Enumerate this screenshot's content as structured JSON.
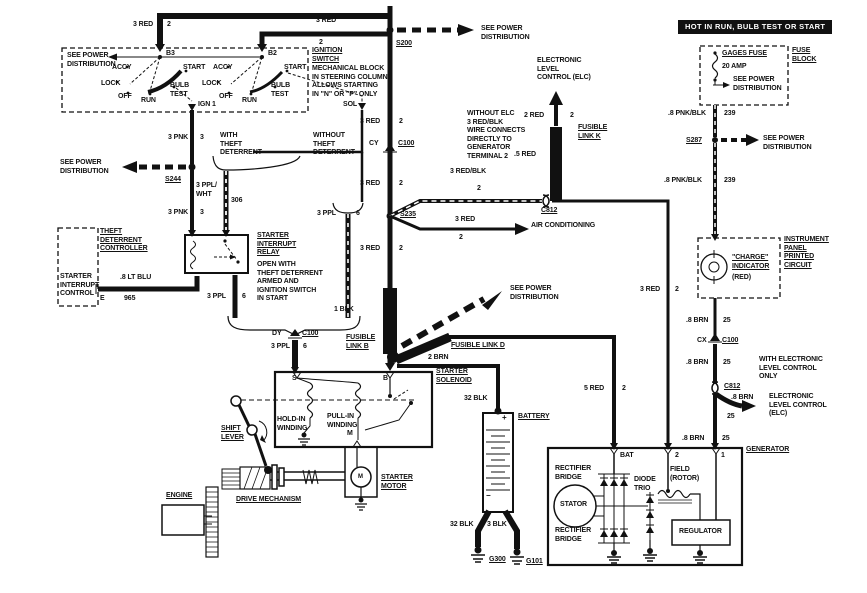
{
  "diagram": {
    "ink_color": "#111111",
    "paper_color": "#ffffff"
  },
  "labels": [
    {
      "n": "wire-3red-top-left",
      "t": "3 RED",
      "x": 133,
      "y": 21
    },
    {
      "n": "wire-ckt2-top-left",
      "t": "2",
      "x": 167,
      "y": 21
    },
    {
      "n": "wire-3red-top-mid",
      "t": "3 RED",
      "x": 316,
      "y": 17
    },
    {
      "n": "wire-ckt2-top-mid",
      "t": "2",
      "x": 319,
      "y": 39
    },
    {
      "n": "splice-s200",
      "t": "S200",
      "x": 396,
      "y": 40,
      "u": 1
    },
    {
      "n": "see-power-dist-top",
      "t": "SEE POWER\nDISTRIBUTION",
      "x": 481,
      "y": 25
    },
    {
      "n": "terminal-b3",
      "t": "B3",
      "x": 166,
      "y": 50
    },
    {
      "n": "terminal-b2",
      "t": "B2",
      "x": 268,
      "y": 50
    },
    {
      "n": "see-power-dist-ign",
      "t": "SEE POWER\nDISTRIBUTION",
      "x": 67,
      "y": 52
    },
    {
      "n": "sw1-accy",
      "t": "ACCY",
      "x": 112,
      "y": 64
    },
    {
      "n": "sw1-lock",
      "t": "LOCK",
      "x": 101,
      "y": 80
    },
    {
      "n": "sw1-off",
      "t": "OFF",
      "x": 118,
      "y": 93
    },
    {
      "n": "sw1-run",
      "t": "RUN",
      "x": 141,
      "y": 97
    },
    {
      "n": "sw1-bulb-test",
      "t": "BULB\nTEST",
      "x": 170,
      "y": 82
    },
    {
      "n": "sw1-start",
      "t": "START",
      "x": 183,
      "y": 64
    },
    {
      "n": "sw2-accy",
      "t": "ACCY",
      "x": 213,
      "y": 64
    },
    {
      "n": "sw2-lock",
      "t": "LOCK",
      "x": 202,
      "y": 80
    },
    {
      "n": "sw2-off",
      "t": "OFF",
      "x": 219,
      "y": 93
    },
    {
      "n": "sw2-run",
      "t": "RUN",
      "x": 242,
      "y": 97
    },
    {
      "n": "sw2-bulb-test",
      "t": "BULB\nTEST",
      "x": 271,
      "y": 82
    },
    {
      "n": "sw2-start",
      "t": "START",
      "x": 284,
      "y": 64
    },
    {
      "n": "terminal-ign1",
      "t": "IGN 1",
      "x": 198,
      "y": 101
    },
    {
      "n": "terminal-sol",
      "t": "SOL",
      "x": 343,
      "y": 101
    },
    {
      "n": "ignition-switch-title",
      "t": "IGNITION\nSWITCH",
      "x": 312,
      "y": 47,
      "u": 1
    },
    {
      "n": "ignition-switch-desc",
      "t": "MECHANICAL BLOCK\nIN STEERING COLUMN\nALLOWS STARTING\nIN \"N\" OR \"P\" ONLY",
      "x": 312,
      "y": 65
    },
    {
      "n": "wire-3pnk-upper",
      "t": "3 PNK",
      "x": 168,
      "y": 134
    },
    {
      "n": "wire-ckt3-upper",
      "t": "3",
      "x": 200,
      "y": 134
    },
    {
      "n": "with-theft-deterrent",
      "t": "WITH\nTHEFT\nDETERRENT",
      "x": 220,
      "y": 132
    },
    {
      "n": "without-theft-deterrent",
      "t": "WITHOUT\nTHEFT\nDETERRENT",
      "x": 313,
      "y": 132
    },
    {
      "n": "see-power-dist-s244",
      "t": "SEE POWER\nDISTRIBUTION",
      "x": 60,
      "y": 159
    },
    {
      "n": "splice-s244",
      "t": "S244",
      "x": 165,
      "y": 176,
      "u": 1
    },
    {
      "n": "wire-3ppl-wht",
      "t": "3 PPL/\nWHT",
      "x": 196,
      "y": 182
    },
    {
      "n": "wire-ckt306",
      "t": "306",
      "x": 231,
      "y": 197
    },
    {
      "n": "wire-3pnk-lower",
      "t": "3 PNK",
      "x": 168,
      "y": 209
    },
    {
      "n": "wire-ckt3-lower",
      "t": "3",
      "x": 200,
      "y": 209
    },
    {
      "n": "wire-3red-trunk1",
      "t": "3 RED",
      "x": 360,
      "y": 118
    },
    {
      "n": "wire-ckt2-trunk1",
      "t": "2",
      "x": 399,
      "y": 118
    },
    {
      "n": "connector-cy",
      "t": "CY",
      "x": 369,
      "y": 140
    },
    {
      "n": "connector-cy-c100",
      "t": "C100",
      "x": 398,
      "y": 140,
      "u": 1
    },
    {
      "n": "wire-3red-trunk2",
      "t": "3 RED",
      "x": 360,
      "y": 180
    },
    {
      "n": "wire-ckt2-trunk2",
      "t": "2",
      "x": 399,
      "y": 180
    },
    {
      "n": "splice-s235",
      "t": "S235",
      "x": 400,
      "y": 211,
      "u": 1
    },
    {
      "n": "wire-3red-blk",
      "t": "3 RED/BLK",
      "x": 450,
      "y": 168
    },
    {
      "n": "wire-ckt2-redblk",
      "t": "2",
      "x": 477,
      "y": 185
    },
    {
      "n": "connector-c812-mid",
      "t": "C812",
      "x": 541,
      "y": 207,
      "u": 1
    },
    {
      "n": "without-elc-note",
      "t": "WITHOUT ELC\n3 RED/BLK\nWIRE CONNECTS\nDIRECTLY TO\nGENERATOR\nTERMINAL 2",
      "x": 467,
      "y": 110
    },
    {
      "n": "elc-top",
      "t": "ELECTRONIC\nLEVEL\nCONTROL (ELC)",
      "x": 537,
      "y": 57
    },
    {
      "n": "wire-2red",
      "t": "2 RED",
      "x": 524,
      "y": 112
    },
    {
      "n": "wire-ckt2-2red",
      "t": "2",
      "x": 570,
      "y": 112
    },
    {
      "n": "fusible-link-k",
      "t": "FUSIBLE\nLINK K",
      "x": 578,
      "y": 124,
      "u": 1
    },
    {
      "n": "wire-5red-small",
      "t": ".5 RED",
      "x": 514,
      "y": 151
    },
    {
      "n": "wire-3red-ac",
      "t": "3 RED",
      "x": 455,
      "y": 216
    },
    {
      "n": "wire-ckt2-ac",
      "t": "2",
      "x": 459,
      "y": 234
    },
    {
      "n": "air-conditioning",
      "t": "AIR CONDITIONING",
      "x": 531,
      "y": 222
    },
    {
      "n": "wire-3red-trunk3",
      "t": "3 RED",
      "x": 360,
      "y": 245
    },
    {
      "n": "wire-ckt2-trunk3",
      "t": "2",
      "x": 399,
      "y": 245
    },
    {
      "n": "see-power-dist-mid",
      "t": "SEE POWER\nDISTRIBUTION",
      "x": 510,
      "y": 285
    },
    {
      "n": "wire-1blk",
      "t": "1 BLK",
      "x": 334,
      "y": 306
    },
    {
      "n": "fusible-link-b",
      "t": "FUSIBLE\nLINK B",
      "x": 346,
      "y": 334,
      "u": 1
    },
    {
      "n": "fusible-link-d",
      "t": "FUSIBLE LINK D",
      "x": 451,
      "y": 342,
      "u": 1
    },
    {
      "n": "wire-2brn",
      "t": "2 BRN",
      "x": 428,
      "y": 354
    },
    {
      "n": "starter-solenoid-title",
      "t": "STARTER\nSOLENOID",
      "x": 436,
      "y": 368,
      "u": 1
    },
    {
      "n": "wire-32blk-top",
      "t": "32 BLK",
      "x": 464,
      "y": 395
    },
    {
      "n": "battery-title",
      "t": "BATTERY",
      "x": 518,
      "y": 413,
      "u": 1
    },
    {
      "n": "wire-5red-bat",
      "t": "5 RED",
      "x": 584,
      "y": 385
    },
    {
      "n": "wire-ckt2-5red",
      "t": "2",
      "x": 622,
      "y": 385
    },
    {
      "n": "wire-3red-gen",
      "t": "3 RED",
      "x": 640,
      "y": 286
    },
    {
      "n": "wire-ckt2-gen",
      "t": "2",
      "x": 675,
      "y": 286
    },
    {
      "n": "theft-deterrent-controller",
      "t": "THEFT\nDETERRENT\nCONTROLLER",
      "x": 100,
      "y": 228,
      "u": 1
    },
    {
      "n": "starter-interrupt-control",
      "t": "STARTER\nINTERRUPT\nCONTROL",
      "x": 60,
      "y": 273
    },
    {
      "n": "terminal-e",
      "t": "E",
      "x": 100,
      "y": 295
    },
    {
      "n": "wire-8ltblu",
      "t": ".8 LT BLU",
      "x": 120,
      "y": 274
    },
    {
      "n": "wire-ckt965",
      "t": "965",
      "x": 124,
      "y": 295
    },
    {
      "n": "starter-interrupt-relay-title",
      "t": "STARTER\nINTERRUPT\nRELAY",
      "x": 257,
      "y": 232,
      "u": 1
    },
    {
      "n": "starter-interrupt-relay-desc",
      "t": "OPEN WITH\nTHEFT DETERRENT\nARMED AND\nIGNITION SWITCH\nIN START",
      "x": 257,
      "y": 261
    },
    {
      "n": "wire-3ppl-relay",
      "t": "3 PPL",
      "x": 207,
      "y": 293
    },
    {
      "n": "wire-ckt6-relay",
      "t": "6",
      "x": 242,
      "y": 293
    },
    {
      "n": "connector-dy",
      "t": "DY",
      "x": 272,
      "y": 330
    },
    {
      "n": "connector-dy-c100",
      "t": "C100",
      "x": 302,
      "y": 330,
      "u": 1
    },
    {
      "n": "wire-3ppl-sol",
      "t": "3 PPL",
      "x": 271,
      "y": 343
    },
    {
      "n": "wire-ckt6-sol",
      "t": "6",
      "x": 303,
      "y": 343
    },
    {
      "n": "wire-3ppl-wo",
      "t": "3 PPL",
      "x": 317,
      "y": 210
    },
    {
      "n": "wire-ckt6-wo",
      "t": "6",
      "x": 356,
      "y": 210
    },
    {
      "n": "terminal-s",
      "t": "S",
      "x": 292,
      "y": 375
    },
    {
      "n": "terminal-b",
      "t": "B",
      "x": 383,
      "y": 375
    },
    {
      "n": "hold-in-winding",
      "t": "HOLD-IN\nWINDING",
      "x": 277,
      "y": 416
    },
    {
      "n": "pull-in-winding",
      "t": "PULL-IN\nWINDING",
      "x": 327,
      "y": 413
    },
    {
      "n": "terminal-m",
      "t": "M",
      "x": 347,
      "y": 430
    },
    {
      "n": "starter-motor-title",
      "t": "STARTER\nMOTOR",
      "x": 381,
      "y": 474,
      "u": 1
    },
    {
      "n": "motor-m",
      "t": "M",
      "x": 358,
      "y": 473,
      "fs": 6
    },
    {
      "n": "shift-lever",
      "t": "SHIFT\nLEVER",
      "x": 221,
      "y": 425,
      "u": 1
    },
    {
      "n": "engine-title",
      "t": "ENGINE",
      "x": 166,
      "y": 492,
      "u": 1
    },
    {
      "n": "drive-mechanism",
      "t": "DRIVE MECHANISM",
      "x": 236,
      "y": 496,
      "u": 1
    },
    {
      "n": "wire-32blk-bot",
      "t": "32 BLK",
      "x": 450,
      "y": 521
    },
    {
      "n": "wire-3blk",
      "t": "3 BLK",
      "x": 487,
      "y": 521
    },
    {
      "n": "ground-g300",
      "t": "G300",
      "x": 489,
      "y": 556,
      "u": 1
    },
    {
      "n": "ground-g101",
      "t": "G101",
      "x": 526,
      "y": 558,
      "u": 1
    },
    {
      "n": "hot-banner",
      "t": "HOT IN RUN, BULB TEST OR START",
      "x": 678,
      "y": 20,
      "inv": 1
    },
    {
      "n": "gages-fuse",
      "t": "GAGES FUSE",
      "x": 722,
      "y": 50,
      "u": 1
    },
    {
      "n": "fuse-amp",
      "t": "20 AMP",
      "x": 722,
      "y": 63
    },
    {
      "n": "see-power-dist-fuse",
      "t": "SEE POWER\nDISTRIBUTION",
      "x": 733,
      "y": 76
    },
    {
      "n": "fuse-block",
      "t": "FUSE\nBLOCK",
      "x": 792,
      "y": 47,
      "u": 1
    },
    {
      "n": "wire-8pnkblk-1",
      "t": ".8 PNK/BLK",
      "x": 668,
      "y": 110
    },
    {
      "n": "wire-ckt239-1",
      "t": "239",
      "x": 724,
      "y": 110
    },
    {
      "n": "splice-s287",
      "t": "S287",
      "x": 686,
      "y": 137,
      "u": 1
    },
    {
      "n": "see-power-dist-s287",
      "t": "SEE POWER\nDISTRIBUTION",
      "x": 763,
      "y": 135
    },
    {
      "n": "wire-8pnkblk-2",
      "t": ".8 PNK/BLK",
      "x": 664,
      "y": 177
    },
    {
      "n": "wire-ckt239-2",
      "t": "239",
      "x": 724,
      "y": 177
    },
    {
      "n": "charge-indicator",
      "t": "\"CHARGE\"\nINDICATOR",
      "x": 732,
      "y": 254,
      "u": 1
    },
    {
      "n": "charge-indicator-color",
      "t": "(RED)",
      "x": 732,
      "y": 274
    },
    {
      "n": "instrument-panel",
      "t": "INSTRUMENT\nPANEL\nPRINTED\nCIRCUIT",
      "x": 784,
      "y": 236,
      "u": 1
    },
    {
      "n": "wire-8brn-1",
      "t": ".8 BRN",
      "x": 686,
      "y": 317
    },
    {
      "n": "wire-ckt25-1",
      "t": "25",
      "x": 723,
      "y": 317
    },
    {
      "n": "connector-cx",
      "t": "CX",
      "x": 697,
      "y": 337
    },
    {
      "n": "connector-cx-c100",
      "t": "C100",
      "x": 722,
      "y": 337,
      "u": 1
    },
    {
      "n": "wire-8brn-2",
      "t": ".8 BRN",
      "x": 686,
      "y": 359
    },
    {
      "n": "wire-ckt25-2",
      "t": "25",
      "x": 723,
      "y": 359
    },
    {
      "n": "with-elc-note",
      "t": "WITH ELECTRONIC\nLEVEL CONTROL\nONLY",
      "x": 759,
      "y": 356
    },
    {
      "n": "connector-c812-right",
      "t": "C812",
      "x": 724,
      "y": 383,
      "u": 1
    },
    {
      "n": "wire-8brn-elc",
      "t": ".8 BRN",
      "x": 731,
      "y": 394
    },
    {
      "n": "wire-ckt25-elc",
      "t": "25",
      "x": 727,
      "y": 413
    },
    {
      "n": "elc-right",
      "t": "ELECTRONIC\nLEVEL CONTROL\n(ELC)",
      "x": 769,
      "y": 393
    },
    {
      "n": "wire-8brn-3",
      "t": ".8 BRN",
      "x": 682,
      "y": 435
    },
    {
      "n": "wire-ckt25-3",
      "t": "25",
      "x": 722,
      "y": 435
    },
    {
      "n": "generator-title",
      "t": "GENERATOR",
      "x": 746,
      "y": 446,
      "u": 1
    },
    {
      "n": "terminal-bat",
      "t": "BAT",
      "x": 620,
      "y": 452
    },
    {
      "n": "terminal-2",
      "t": "2",
      "x": 675,
      "y": 452
    },
    {
      "n": "terminal-1",
      "t": "1",
      "x": 721,
      "y": 452
    },
    {
      "n": "rectifier-bridge-top",
      "t": "RECTIFIER\nBRIDGE",
      "x": 555,
      "y": 465
    },
    {
      "n": "stator",
      "t": "STATOR",
      "x": 560,
      "y": 501
    },
    {
      "n": "diode-trio",
      "t": "DIODE\nTRIO",
      "x": 634,
      "y": 476
    },
    {
      "n": "field-rotor",
      "t": "FIELD\n(ROTOR)",
      "x": 670,
      "y": 466
    },
    {
      "n": "regulator",
      "t": "REGULATOR",
      "x": 679,
      "y": 528
    },
    {
      "n": "rectifier-bridge-bottom",
      "t": "RECTIFIER\nBRIDGE",
      "x": 555,
      "y": 527
    },
    {
      "n": "battery-plus",
      "t": "+",
      "x": 502,
      "y": 414,
      "fs": 8
    },
    {
      "n": "battery-minus",
      "t": "−",
      "x": 486,
      "y": 492,
      "fs": 8
    }
  ]
}
